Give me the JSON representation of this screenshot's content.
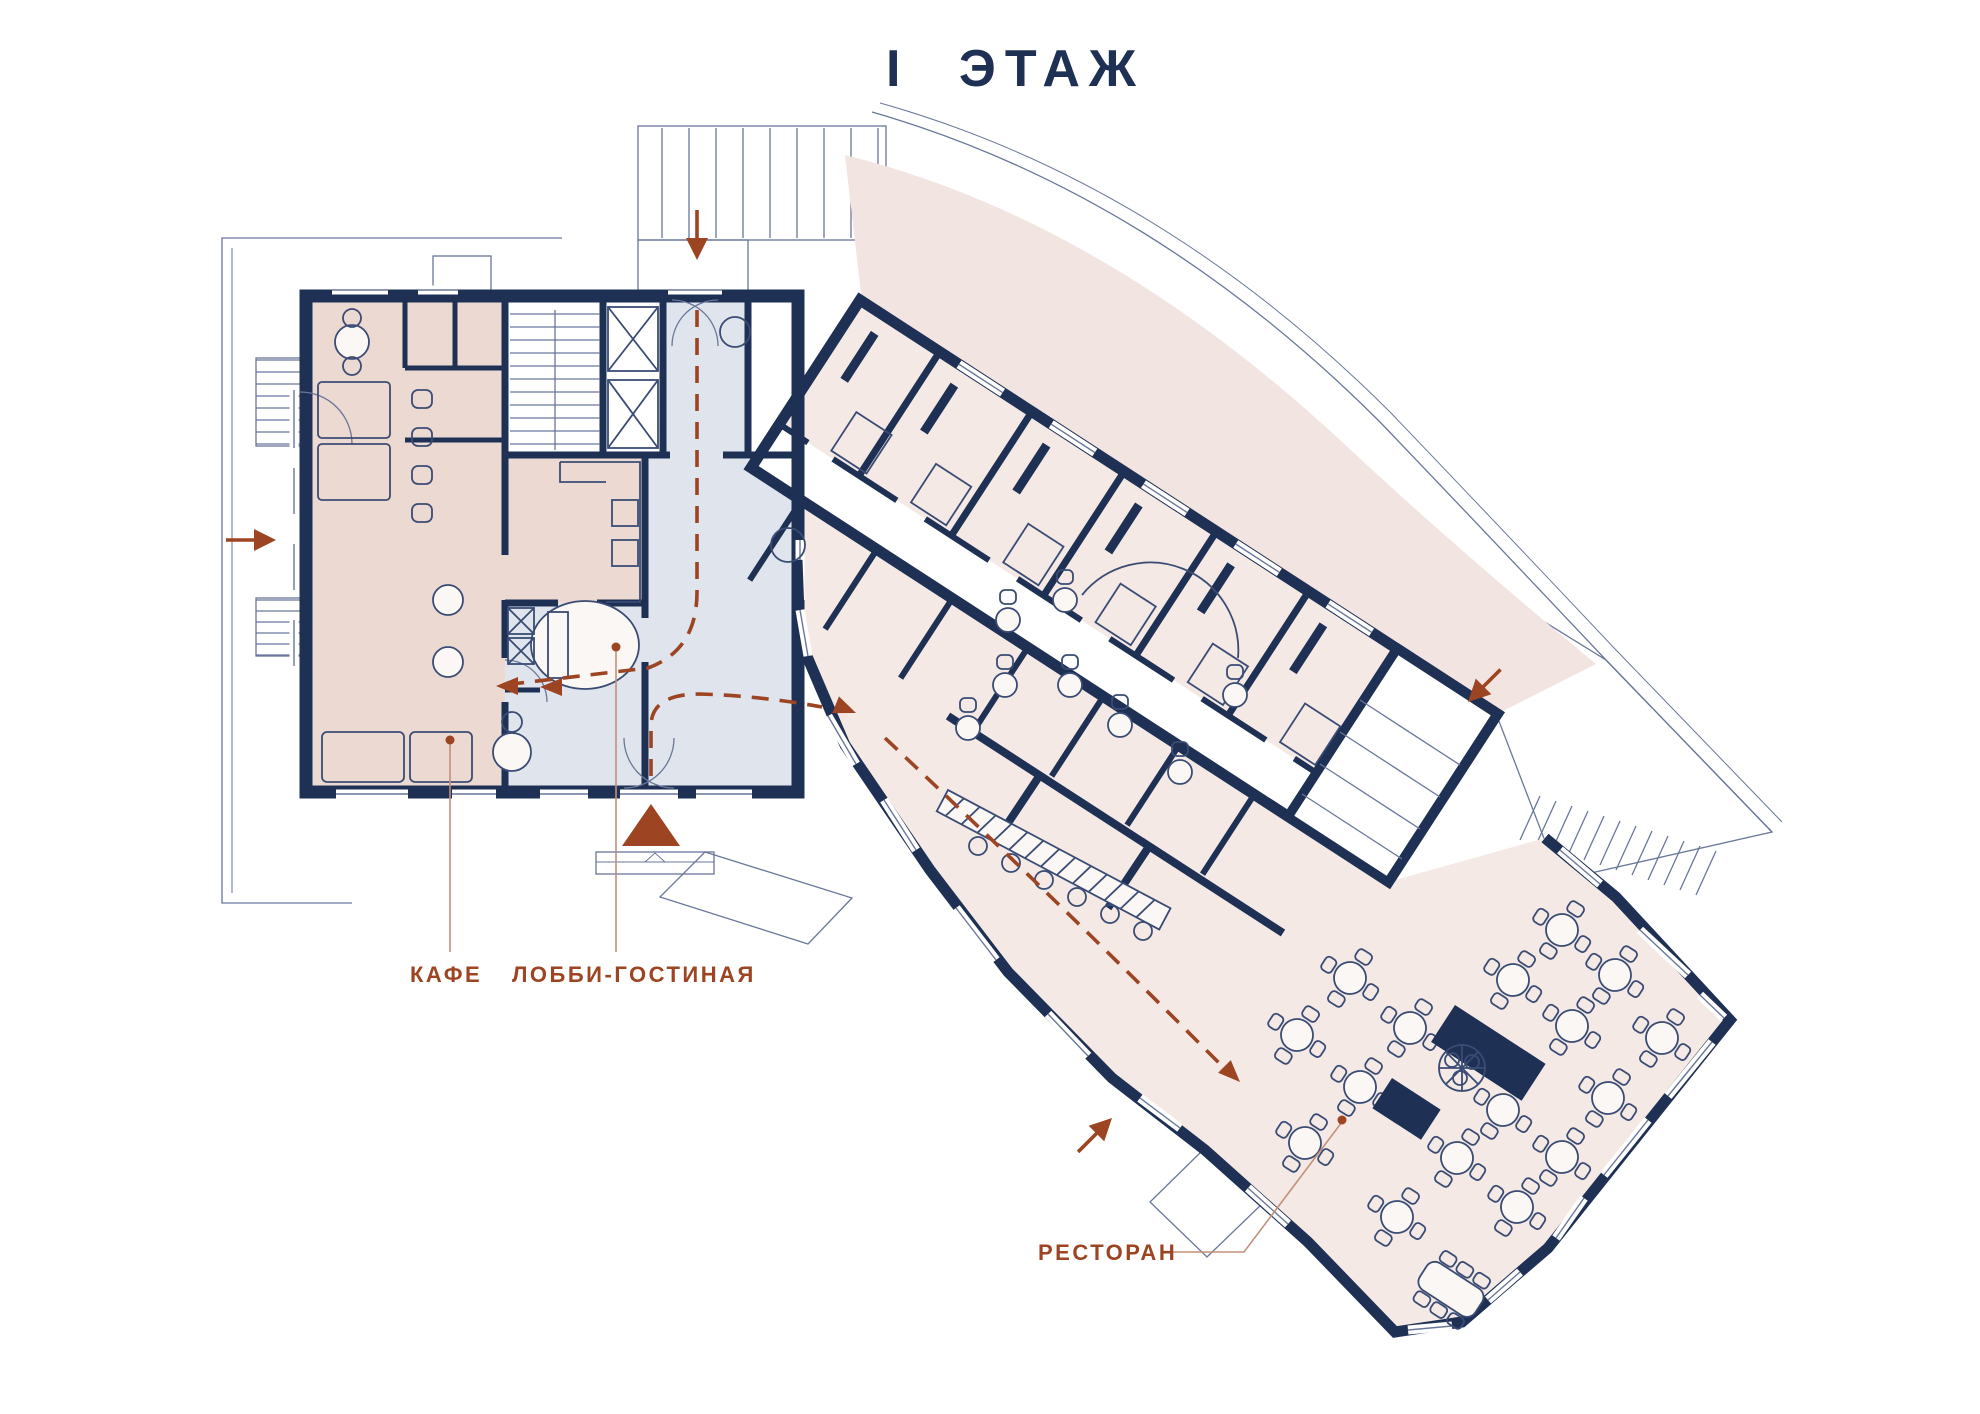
{
  "title": "I ЭТАЖ",
  "labels": {
    "cafe": "КАФЕ",
    "lobby": "ЛОББИ-ГОСТИНАЯ",
    "restaurant": "РЕСТОРАН"
  },
  "colors": {
    "navy": "#1e3054",
    "furn": "#3a4c74",
    "line": "#69779a",
    "accent": "#9d4422",
    "leader": "#c3907a",
    "cafe_fill": "#ecd9d1",
    "rooms_fill": "#f4e9e5",
    "lobby_fill": "#e0e4ed",
    "terrace_fill": "#f2e4e0"
  }
}
